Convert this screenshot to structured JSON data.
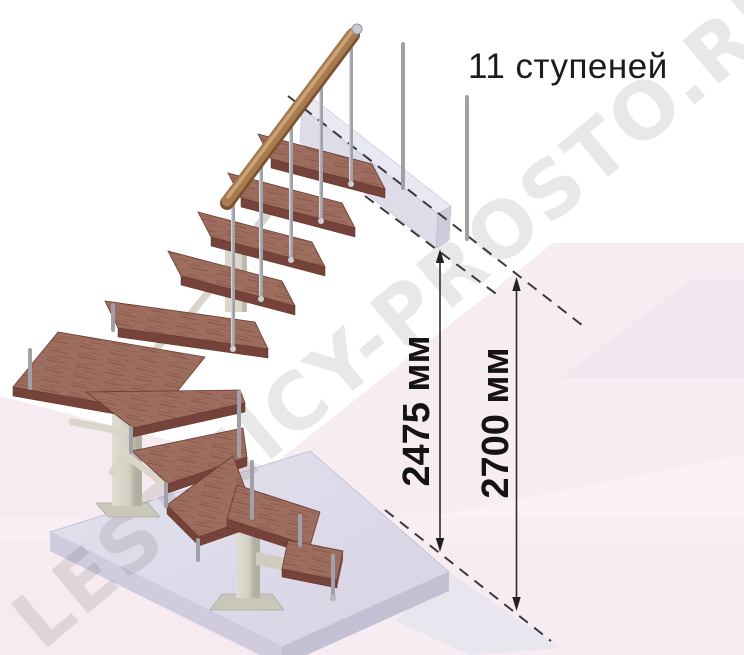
{
  "meta": {
    "kind": "staircase-dimension-diagram",
    "canvas": {
      "width": 744,
      "height": 655,
      "background": "#ffffff"
    }
  },
  "title": {
    "text": "11 ступеней",
    "steps_count": 11
  },
  "watermark": {
    "text": "LESTNICY-PROSTO.RU"
  },
  "dimensions": [
    {
      "id": "height-to-landing-underside",
      "label": "2475 мм",
      "value": 2475,
      "unit": "мм"
    },
    {
      "id": "floor-to-floor-height",
      "label": "2700 мм",
      "value": 2700,
      "unit": "мм"
    }
  ],
  "illustration": {
    "type": "3d-render",
    "subject": "modular winder staircase with 90-degree turn, 11 steps, wooden treads, metal balusters, wooden handrail, floor slab and upper landing beam",
    "colors": {
      "tread_wood": "#9d6d5f",
      "tread_edge": "#75433a",
      "handrail_wood": "#a87a4e",
      "metal_rod": "#9fa0a8",
      "support_cream": "#d6d3c6",
      "platform_lavender": "#dcd9e8",
      "landing_beam": "#dadae8",
      "background_pink": "#f8ecf3",
      "dimension_line": "#2e2e2e",
      "watermark_gray": "#e9e9e9",
      "text": "#1c1c1c"
    }
  }
}
